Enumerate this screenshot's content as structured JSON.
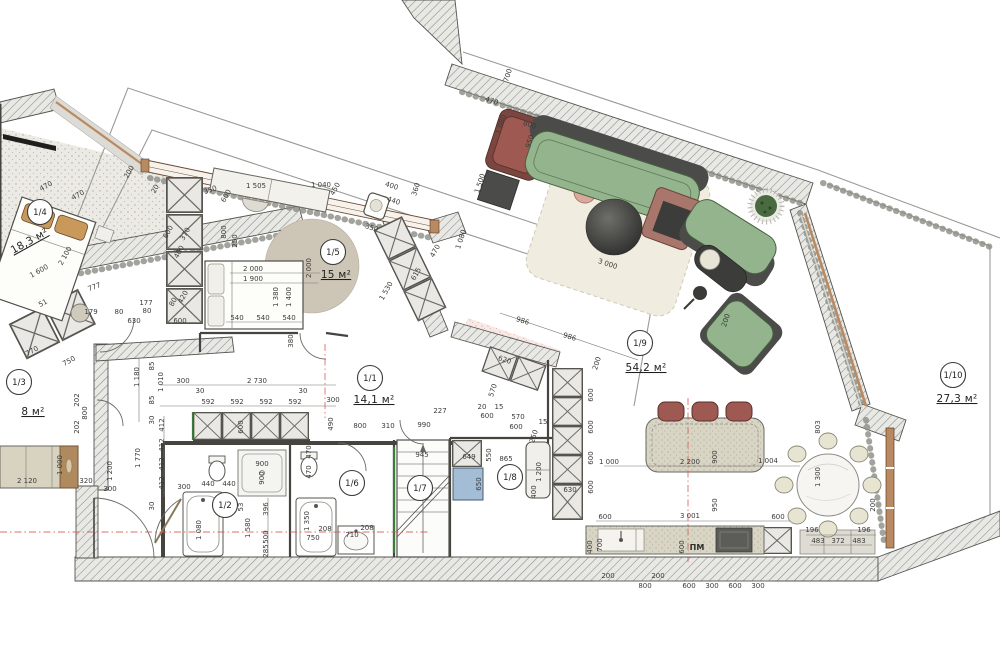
{
  "title": "Apartment floor plan with furniture and dimensions (mm)",
  "units": "м²",
  "colors": {
    "wall_line": "#55544f",
    "sofa_green": "#93b48d",
    "sofa_dark": "#4b4b49",
    "accent_red": "#9e5a52",
    "rust_table": "#a8766a",
    "wood_tan": "#c9995c",
    "window_brown": "#b98a62",
    "rug_cream": "#f0ecdf",
    "rug_taupe": "#cdc6b6",
    "table_dark": "#3c3c3a",
    "washer_blue": "#a3bdd6",
    "chair_cream": "#e8e4d2",
    "counter_beige": "#d9d5c5",
    "wardrobe_tan": "#d8d2c0",
    "axis_red": "#d9534a",
    "green_accent": "#3e7a3a"
  },
  "rooms": [
    {
      "label": "1/4",
      "area": "18,3 м²",
      "bx": 40,
      "by": 212,
      "ax": 31,
      "ay": 244,
      "r": -29
    },
    {
      "label": "1/5",
      "area": "15 м²",
      "bx": 333,
      "by": 252,
      "ax": 336,
      "ay": 278
    },
    {
      "label": "1/3",
      "area": "8 м²",
      "bx": 19,
      "by": 382,
      "ax": 33,
      "ay": 415
    },
    {
      "label": "1/1",
      "area": "14,1 м²",
      "bx": 370,
      "by": 378,
      "ax": 374,
      "ay": 403
    },
    {
      "label": "1/2",
      "bx": 225,
      "by": 505
    },
    {
      "label": "1/6",
      "bx": 352,
      "by": 483
    },
    {
      "label": "1/7",
      "bx": 420,
      "by": 488
    },
    {
      "label": "1/8",
      "bx": 510,
      "by": 477
    },
    {
      "label": "1/9",
      "area": "54,2 м²",
      "bx": 640,
      "by": 343,
      "ax": 646,
      "ay": 371
    },
    {
      "label": "1/10",
      "area": "27,3 м²",
      "bx": 953,
      "by": 375,
      "ax": 957,
      "ay": 402
    }
  ],
  "dim_labels": [
    {
      "t": "470",
      "x": 47,
      "y": 188,
      "r": -29
    },
    {
      "t": "470",
      "x": 79,
      "y": 197,
      "r": -29
    },
    {
      "t": "1 600",
      "x": 40,
      "y": 273,
      "r": -29
    },
    {
      "t": "2 100",
      "x": 67,
      "y": 257,
      "r": -61
    },
    {
      "t": "777",
      "x": 95,
      "y": 289,
      "r": -20
    },
    {
      "t": "51",
      "x": 44,
      "y": 305,
      "r": -29
    },
    {
      "t": "179",
      "x": 91,
      "y": 314
    },
    {
      "t": "200",
      "x": 131,
      "y": 173,
      "r": -61
    },
    {
      "t": "20",
      "x": 157,
      "y": 190,
      "r": -61
    },
    {
      "t": "400",
      "x": 181,
      "y": 253,
      "r": -61
    },
    {
      "t": "600",
      "x": 170,
      "y": 233,
      "r": -61
    },
    {
      "t": "370",
      "x": 187,
      "y": 235,
      "r": -61
    },
    {
      "t": "80",
      "x": 175,
      "y": 303,
      "r": -61
    },
    {
      "t": "420",
      "x": 185,
      "y": 298,
      "r": -61
    },
    {
      "t": "177",
      "x": 146,
      "y": 305
    },
    {
      "t": "80",
      "x": 147,
      "y": 313
    },
    {
      "t": "80",
      "x": 119,
      "y": 314
    },
    {
      "t": "630",
      "x": 134,
      "y": 323
    },
    {
      "t": "600",
      "x": 180,
      "y": 323
    },
    {
      "t": "350",
      "x": 211,
      "y": 192,
      "r": -20
    },
    {
      "t": "600",
      "x": 228,
      "y": 197,
      "r": -61
    },
    {
      "t": "1 505",
      "x": 256,
      "y": 188
    },
    {
      "t": "1 040",
      "x": 321,
      "y": 187
    },
    {
      "t": "450",
      "x": 337,
      "y": 190,
      "r": -61
    },
    {
      "t": "800",
      "x": 226,
      "y": 232,
      "r": -90
    },
    {
      "t": "250",
      "x": 237,
      "y": 241,
      "r": -90
    },
    {
      "t": "400",
      "x": 391,
      "y": 188,
      "r": 18
    },
    {
      "t": "440",
      "x": 393,
      "y": 203,
      "r": 18
    },
    {
      "t": "350",
      "x": 371,
      "y": 230,
      "r": 18
    },
    {
      "t": "360",
      "x": 418,
      "y": 190,
      "r": -72
    },
    {
      "t": "2 000",
      "x": 253,
      "y": 271
    },
    {
      "t": "1 900",
      "x": 253,
      "y": 281
    },
    {
      "t": "1 380",
      "x": 278,
      "y": 297,
      "r": -90
    },
    {
      "t": "1 400",
      "x": 291,
      "y": 297,
      "r": -90
    },
    {
      "t": "2 000",
      "x": 311,
      "y": 268,
      "r": -90
    },
    {
      "t": "540",
      "x": 237,
      "y": 320
    },
    {
      "t": "540",
      "x": 263,
      "y": 320
    },
    {
      "t": "540",
      "x": 289,
      "y": 320
    },
    {
      "t": "380",
      "x": 293,
      "y": 341,
      "r": -90
    },
    {
      "t": "1 530",
      "x": 388,
      "y": 292,
      "r": -61
    },
    {
      "t": "615",
      "x": 418,
      "y": 275,
      "r": -61
    },
    {
      "t": "470",
      "x": 437,
      "y": 252,
      "r": -61
    },
    {
      "t": "700",
      "x": 510,
      "y": 76,
      "r": -72
    },
    {
      "t": "470",
      "x": 491,
      "y": 103,
      "r": 18
    },
    {
      "t": "1 080",
      "x": 503,
      "y": 125,
      "r": -72
    },
    {
      "t": "800",
      "x": 529,
      "y": 127,
      "r": 18
    },
    {
      "t": "950",
      "x": 532,
      "y": 142,
      "r": -72
    },
    {
      "t": "1 500",
      "x": 482,
      "y": 184,
      "r": -72
    },
    {
      "t": "1 080",
      "x": 463,
      "y": 240,
      "r": -72
    },
    {
      "t": "3 000",
      "x": 607,
      "y": 266,
      "r": 18
    },
    {
      "t": "200",
      "x": 728,
      "y": 321,
      "r": -72
    },
    {
      "t": "2 730",
      "x": 257,
      "y": 383
    },
    {
      "t": "30",
      "x": 200,
      "y": 393
    },
    {
      "t": "592",
      "x": 208,
      "y": 404
    },
    {
      "t": "592",
      "x": 237,
      "y": 404
    },
    {
      "t": "592",
      "x": 266,
      "y": 404
    },
    {
      "t": "592",
      "x": 295,
      "y": 404
    },
    {
      "t": "30",
      "x": 303,
      "y": 393
    },
    {
      "t": "300",
      "x": 333,
      "y": 402
    },
    {
      "t": "600",
      "x": 243,
      "y": 427,
      "r": -90
    },
    {
      "t": "490",
      "x": 333,
      "y": 424,
      "r": -90
    },
    {
      "t": "800",
      "x": 360,
      "y": 428
    },
    {
      "t": "310",
      "x": 388,
      "y": 428
    },
    {
      "t": "990",
      "x": 424,
      "y": 427
    },
    {
      "t": "227",
      "x": 440,
      "y": 413
    },
    {
      "t": "770",
      "x": 33,
      "y": 353,
      "r": -29
    },
    {
      "t": "750",
      "x": 70,
      "y": 363,
      "r": -29
    },
    {
      "t": "202",
      "x": 79,
      "y": 400,
      "r": -90
    },
    {
      "t": "800",
      "x": 87,
      "y": 413,
      "r": -90
    },
    {
      "t": "202",
      "x": 79,
      "y": 427,
      "r": -90
    },
    {
      "t": "2 120",
      "x": 27,
      "y": 483
    },
    {
      "t": "1 000",
      "x": 62,
      "y": 465,
      "r": -90
    },
    {
      "t": "320",
      "x": 86,
      "y": 483
    },
    {
      "t": "1 200",
      "x": 112,
      "y": 471,
      "r": -90
    },
    {
      "t": "300",
      "x": 110,
      "y": 491
    },
    {
      "t": "1 180",
      "x": 139,
      "y": 377,
      "r": -90
    },
    {
      "t": "85",
      "x": 154,
      "y": 366,
      "r": -90
    },
    {
      "t": "1 010",
      "x": 163,
      "y": 382,
      "r": -90
    },
    {
      "t": "85",
      "x": 154,
      "y": 400,
      "r": -90
    },
    {
      "t": "300",
      "x": 183,
      "y": 383
    },
    {
      "t": "30",
      "x": 154,
      "y": 420,
      "r": -90
    },
    {
      "t": "412",
      "x": 164,
      "y": 425,
      "r": -90
    },
    {
      "t": "412",
      "x": 164,
      "y": 445,
      "r": -90
    },
    {
      "t": "412",
      "x": 164,
      "y": 464,
      "r": -90
    },
    {
      "t": "412",
      "x": 164,
      "y": 483,
      "r": -90
    },
    {
      "t": "1 770",
      "x": 140,
      "y": 458,
      "r": -90
    },
    {
      "t": "300",
      "x": 184,
      "y": 489
    },
    {
      "t": "30",
      "x": 154,
      "y": 506,
      "r": -90
    },
    {
      "t": "440",
      "x": 208,
      "y": 486
    },
    {
      "t": "440",
      "x": 229,
      "y": 486
    },
    {
      "t": "900",
      "x": 262,
      "y": 466
    },
    {
      "t": "900",
      "x": 264,
      "y": 478,
      "r": -90
    },
    {
      "t": "53",
      "x": 243,
      "y": 507,
      "r": -90
    },
    {
      "t": "396",
      "x": 268,
      "y": 509,
      "r": -90
    },
    {
      "t": "500",
      "x": 268,
      "y": 537,
      "r": -90
    },
    {
      "t": "285",
      "x": 268,
      "y": 551,
      "r": -90
    },
    {
      "t": "1 580",
      "x": 250,
      "y": 528,
      "r": -90
    },
    {
      "t": "1 080",
      "x": 201,
      "y": 530,
      "r": -90
    },
    {
      "t": "470",
      "x": 311,
      "y": 452,
      "r": -90
    },
    {
      "t": "470",
      "x": 311,
      "y": 472,
      "r": -90
    },
    {
      "t": "1 350",
      "x": 309,
      "y": 521,
      "r": -90
    },
    {
      "t": "750",
      "x": 313,
      "y": 540
    },
    {
      "t": "208",
      "x": 325,
      "y": 531
    },
    {
      "t": "710",
      "x": 352,
      "y": 537
    },
    {
      "t": "208",
      "x": 367,
      "y": 530
    },
    {
      "t": "945",
      "x": 422,
      "y": 457
    },
    {
      "t": "649",
      "x": 469,
      "y": 459
    },
    {
      "t": "550",
      "x": 491,
      "y": 455,
      "r": -90
    },
    {
      "t": "650",
      "x": 481,
      "y": 484,
      "r": -90
    },
    {
      "t": "865",
      "x": 506,
      "y": 461
    },
    {
      "t": "400",
      "x": 536,
      "y": 492,
      "r": -90
    },
    {
      "t": "1 200",
      "x": 541,
      "y": 472,
      "r": -90
    },
    {
      "t": "630",
      "x": 570,
      "y": 492
    },
    {
      "t": "600",
      "x": 593,
      "y": 395,
      "r": -90
    },
    {
      "t": "600",
      "x": 593,
      "y": 427,
      "r": -90
    },
    {
      "t": "600",
      "x": 593,
      "y": 458,
      "r": -90
    },
    {
      "t": "600",
      "x": 593,
      "y": 487,
      "r": -90
    },
    {
      "t": "986",
      "x": 522,
      "y": 323,
      "r": 18
    },
    {
      "t": "986",
      "x": 569,
      "y": 339,
      "r": 18
    },
    {
      "t": "200",
      "x": 599,
      "y": 364,
      "r": -72
    },
    {
      "t": "620",
      "x": 504,
      "y": 362,
      "r": 18
    },
    {
      "t": "570",
      "x": 495,
      "y": 391,
      "r": -72
    },
    {
      "t": "20",
      "x": 482,
      "y": 409
    },
    {
      "t": "15",
      "x": 499,
      "y": 409
    },
    {
      "t": "600",
      "x": 487,
      "y": 418
    },
    {
      "t": "570",
      "x": 518,
      "y": 419
    },
    {
      "t": "600",
      "x": 516,
      "y": 429
    },
    {
      "t": "15",
      "x": 543,
      "y": 424
    },
    {
      "t": "250",
      "x": 536,
      "y": 437,
      "r": -72
    },
    {
      "t": "1 000",
      "x": 609,
      "y": 464
    },
    {
      "t": "2 200",
      "x": 690,
      "y": 464
    },
    {
      "t": "900",
      "x": 717,
      "y": 457,
      "r": -90
    },
    {
      "t": "1 004",
      "x": 768,
      "y": 463
    },
    {
      "t": "950",
      "x": 717,
      "y": 505,
      "r": -90
    },
    {
      "t": "600",
      "x": 605,
      "y": 519
    },
    {
      "t": "3 001",
      "x": 690,
      "y": 518
    },
    {
      "t": "600",
      "x": 778,
      "y": 519
    },
    {
      "t": "700",
      "x": 602,
      "y": 545,
      "r": -90
    },
    {
      "t": "400",
      "x": 592,
      "y": 547,
      "r": -90
    },
    {
      "t": "600",
      "x": 684,
      "y": 547,
      "r": -90
    },
    {
      "t": "200",
      "x": 608,
      "y": 578
    },
    {
      "t": "200",
      "x": 658,
      "y": 578
    },
    {
      "t": "800",
      "x": 645,
      "y": 588
    },
    {
      "t": "600",
      "x": 689,
      "y": 588
    },
    {
      "t": "300",
      "x": 712,
      "y": 588
    },
    {
      "t": "600",
      "x": 735,
      "y": 588
    },
    {
      "t": "300",
      "x": 758,
      "y": 588
    },
    {
      "t": "196",
      "x": 812,
      "y": 532
    },
    {
      "t": "483",
      "x": 818,
      "y": 543
    },
    {
      "t": "372",
      "x": 838,
      "y": 543
    },
    {
      "t": "483",
      "x": 859,
      "y": 543
    },
    {
      "t": "196",
      "x": 864,
      "y": 532
    },
    {
      "t": "200",
      "x": 875,
      "y": 505,
      "r": -90
    },
    {
      "t": "1 300",
      "x": 820,
      "y": 477,
      "r": -90
    },
    {
      "t": "803",
      "x": 820,
      "y": 427,
      "r": -90
    }
  ],
  "annotations": [
    {
      "t": "ПМ",
      "x": 697,
      "y": 550
    }
  ]
}
